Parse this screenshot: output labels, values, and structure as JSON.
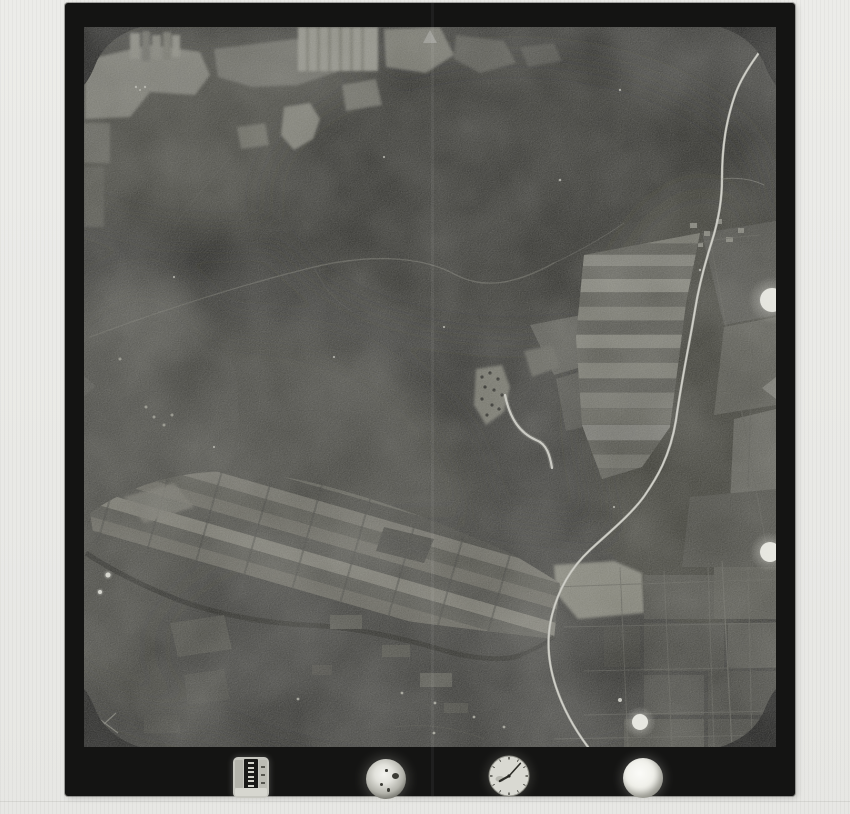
{
  "scene": {
    "kind": "aerial-photograph-film-frame-scan",
    "content_summary": "black-and-white vertical aerial photo: dark forest, field mosaics upper-left and lower-left, striped fields and a bright winding road on the right, small village with stream at center, instrument band at bottom"
  },
  "palette": {
    "paper": "#ebebe8",
    "frame_border": "#141413",
    "image_base": "#2f2f2c",
    "road_bright": "#b2b2aa",
    "highlight": "#d9d9d1",
    "dial_white": "#f2f2ee"
  },
  "fiducials": {
    "top_triangle": {
      "cx": 346,
      "cy": 9
    },
    "right_triangle": {
      "cy": 361
    },
    "left_triangle": {
      "cy": 359
    },
    "corner_notches": 4
  },
  "light_spots": [
    {
      "cx": 688,
      "cy": 273,
      "r": 12
    },
    {
      "cx": 686,
      "cy": 525,
      "r": 10
    },
    {
      "cx": 556,
      "cy": 695,
      "r": 8
    }
  ],
  "instruments": {
    "frame_counter": {
      "x": 168,
      "y": 754,
      "w": 36,
      "h": 41,
      "digit_marks": 6
    },
    "bubble_level": {
      "cx": 321,
      "cy": 776,
      "r": 20
    },
    "clock": {
      "cx": 444,
      "cy": 773,
      "r": 22,
      "minute_angle_deg": 42,
      "hour_angle_deg": 241,
      "tick_count": 12
    },
    "blank_dial": {
      "cx": 578,
      "cy": 775,
      "r": 20
    }
  },
  "scan_artifact": {
    "x_in_print": 366,
    "width": 3
  }
}
